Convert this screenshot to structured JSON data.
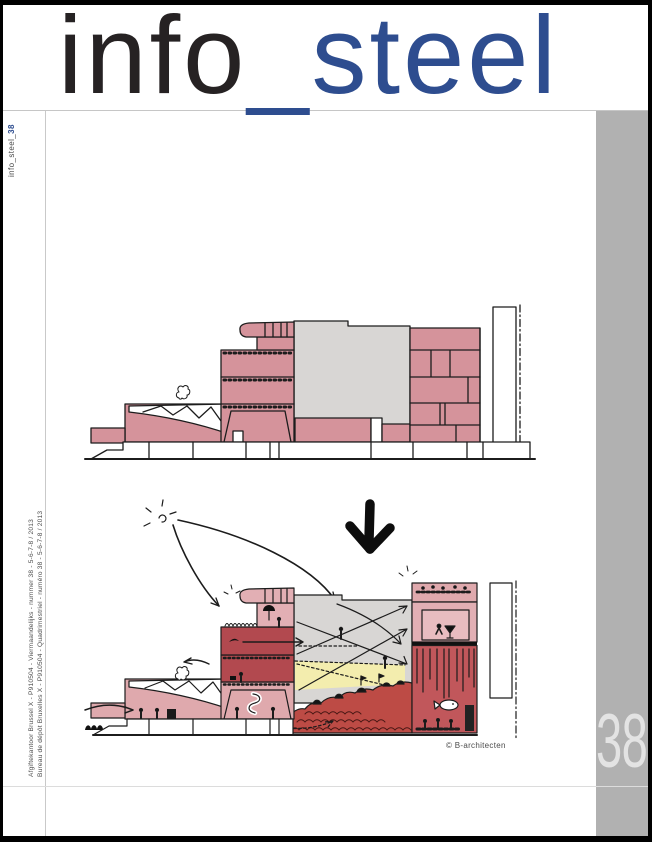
{
  "masthead": {
    "title_part1": "info",
    "title_part2": "_steel"
  },
  "spine": {
    "label_prefix": "info_steel_",
    "label_issue": "38"
  },
  "postal": {
    "line1": "Afgiftekantoor Brussel X - P910504 - Viermaandelijks - nummer 38 - 5-6-7-8 / 2013",
    "line2": "Bureau de dépôt Bruxelles X - P910504 - Quadrimestriel - numéro 38 - 5-6-7-8 / 2013"
  },
  "issue_badge": {
    "number": "38"
  },
  "drawing": {
    "credit": "© B-architecten"
  },
  "palette": {
    "masthead_blue": "#2e4d8f",
    "masthead_black": "#262223",
    "pink": "#d5939b",
    "light_pink": "#e2afb4",
    "rose": "#dfa9ad",
    "dark_red": "#b2494f",
    "brick_red": "#bd4b45",
    "rope_red": "#c1575b",
    "hall_gray": "#d8d6d4",
    "accent_yellow": "#f3edae",
    "column_gray": "#b1b1b1",
    "ink": "#1c1c1c"
  }
}
